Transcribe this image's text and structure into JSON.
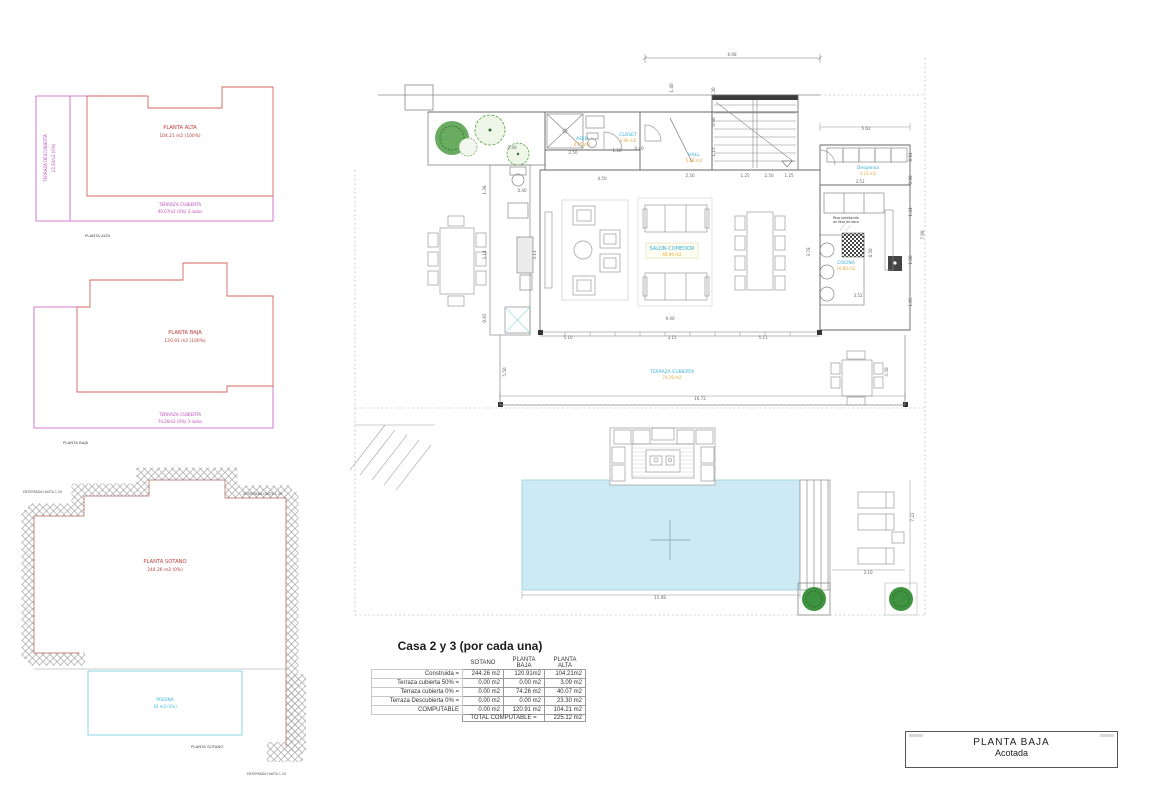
{
  "plans_panel": {
    "alta": {
      "room": "PLANTA ALTA",
      "room_area": "104.21 m2 (100%)",
      "terraza_descubierta": "TERRAZA DESCUBIERTA",
      "terraza_descubierta_area": "23.30m2 (0%)",
      "terraza_cubierta": "TERRAZA CUBIERTA",
      "terraza_cubierta_area": "40.07m2 (0%) 3 lados",
      "caption": "PLANTA ALTA"
    },
    "baja": {
      "room": "PLANTA BAJA",
      "room_area": "120.91  m2 (100%)",
      "terraza_cubierta": "TERRAZA CUBIERTA",
      "terraza_cubierta_area": "74.26m2 (0%) 3 lados",
      "caption": "PLANTA BAJA"
    },
    "sotano": {
      "room": "PLANTA SOTANO",
      "room_area": "244.26  m2 (0%)",
      "piscina": "PISCINA",
      "piscina_area": "40  m2 (0%)",
      "caption": "PLANTA SOTANO",
      "note_top_left": "ENTERRADA HASTA  1.20",
      "note_top_right": "ENTERRADA HASTA  1.20",
      "note_bottom_right": "ENTERRADA HASTA  1.20"
    }
  },
  "main_plan": {
    "rooms": [
      {
        "name": "ASEO",
        "area": "4.25 m2",
        "x": 242,
        "y": 110
      },
      {
        "name": "CLOSET",
        "area": "1.90 m2",
        "x": 288,
        "y": 106
      },
      {
        "name": "HALL",
        "area": "5.88 m2",
        "x": 354,
        "y": 126
      },
      {
        "name": "Despensa",
        "area": "3.21 m2",
        "x": 528,
        "y": 139
      },
      {
        "name": "COCINA",
        "area": "16.80 m2",
        "x": 506,
        "y": 234
      },
      {
        "name": "SALON-COMEDOR",
        "area": "48.96 m2",
        "x": 332,
        "y": 220,
        "boxed": true,
        "lg": true
      },
      {
        "name": "TERRAZA CUBIERTA",
        "area": "74.26 m2",
        "x": 332,
        "y": 343
      }
    ],
    "notes": [
      {
        "t": "Para ventilación",
        "x": 506,
        "y": 189
      },
      {
        "t": "en fase de obra",
        "x": 506,
        "y": 193
      }
    ],
    "dimensions": [
      {
        "t": "6.08",
        "x": 392,
        "y": 26
      },
      {
        "t": "1.40",
        "x": 333,
        "y": 58,
        "r": -90
      },
      {
        "t": "5.62",
        "x": 526,
        "y": 100
      },
      {
        "t": "2.50",
        "x": 233,
        "y": 124
      },
      {
        "t": "1.60",
        "x": 277,
        "y": 122
      },
      {
        "t": "0.40",
        "x": 299,
        "y": 120
      },
      {
        "t": "4.50",
        "x": 262,
        "y": 150
      },
      {
        "t": "0.40",
        "x": 182,
        "y": 162
      },
      {
        "t": "2.50",
        "x": 350,
        "y": 147
      },
      {
        "t": "1.25",
        "x": 405,
        "y": 147
      },
      {
        "t": "2.50",
        "x": 429,
        "y": 147
      },
      {
        "t": "1.25",
        "x": 449,
        "y": 147
      },
      {
        "t": "1.30",
        "x": 375,
        "y": 62,
        "r": -90
      },
      {
        "t": "0.90",
        "x": 375,
        "y": 92,
        "r": -90
      },
      {
        "t": "1.15",
        "x": 375,
        "y": 122,
        "r": -90
      },
      {
        "t": "3.52",
        "x": 520,
        "y": 153
      },
      {
        "t": "0.91",
        "x": 572,
        "y": 127,
        "r": -90
      },
      {
        "t": "0.90",
        "x": 572,
        "y": 150,
        "r": -90
      },
      {
        "t": "1.44",
        "x": 572,
        "y": 182,
        "r": -90
      },
      {
        "t": "1.88",
        "x": 572,
        "y": 230,
        "r": -90
      },
      {
        "t": "1.05",
        "x": 572,
        "y": 272,
        "r": -90
      },
      {
        "t": "7.09",
        "x": 584,
        "y": 205,
        "r": -90
      },
      {
        "t": "4.50",
        "x": 532,
        "y": 223,
        "r": -90
      },
      {
        "t": "3.52",
        "x": 518,
        "y": 267
      },
      {
        "t": "9.40",
        "x": 330,
        "y": 290
      },
      {
        "t": "5.10",
        "x": 228,
        "y": 309
      },
      {
        "t": "3.15",
        "x": 332,
        "y": 309
      },
      {
        "t": "5.11",
        "x": 423,
        "y": 309
      },
      {
        "t": "3.13",
        "x": 196,
        "y": 225,
        "r": -90
      },
      {
        "t": "3.78",
        "x": 470,
        "y": 222,
        "r": -90
      },
      {
        "t": "1.36",
        "x": 146,
        "y": 160,
        "r": -90
      },
      {
        "t": "3.14",
        "x": 146,
        "y": 225,
        "r": -90
      },
      {
        "t": "0.65",
        "x": 146,
        "y": 288,
        "r": -90
      },
      {
        "t": "0.40",
        "x": 172,
        "y": 119
      },
      {
        "t": "16.72",
        "x": 360,
        "y": 370
      },
      {
        "t": "5.50",
        "x": 166,
        "y": 342,
        "r": -90
      },
      {
        "t": "5.50",
        "x": 548,
        "y": 342,
        "r": -90
      },
      {
        "t": "15.08",
        "x": 320,
        "y": 569
      },
      {
        "t": "3.10",
        "x": 528,
        "y": 544
      },
      {
        "t": "7.22",
        "x": 574,
        "y": 487,
        "r": -90
      }
    ]
  },
  "summary": {
    "title": "Casa 2 y 3 (por cada una)",
    "columns": [
      "SOTANO",
      "PLANTA BAJA",
      "PLANTA ALTA"
    ],
    "rows": [
      {
        "label": "Construida =",
        "values": [
          "244.26 m2",
          "120.91m2",
          "104.21m2"
        ]
      },
      {
        "label": "Terraza cubierta 50% =",
        "values": [
          "0.00 m2",
          "0.00 m2",
          "3.09 m2"
        ]
      },
      {
        "label": "Terraza cubierta 0% =",
        "values": [
          "0.00 m2",
          "74.26 m2",
          "40.07 m2"
        ]
      },
      {
        "label": "Terraza Descubierta 0% =",
        "values": [
          "0.00 m2",
          "0.00 m2",
          "23.30 m2"
        ]
      },
      {
        "label": "COMPUTABLE",
        "values": [
          "0.00 m2",
          "120.91 m2",
          "104.21 m2"
        ]
      }
    ],
    "total_label": "TOTAL COMPUTABLE =",
    "total_value": "225.12 m2"
  },
  "title_block": {
    "line1": "PLANTA BAJA",
    "line2": "Acotada"
  }
}
